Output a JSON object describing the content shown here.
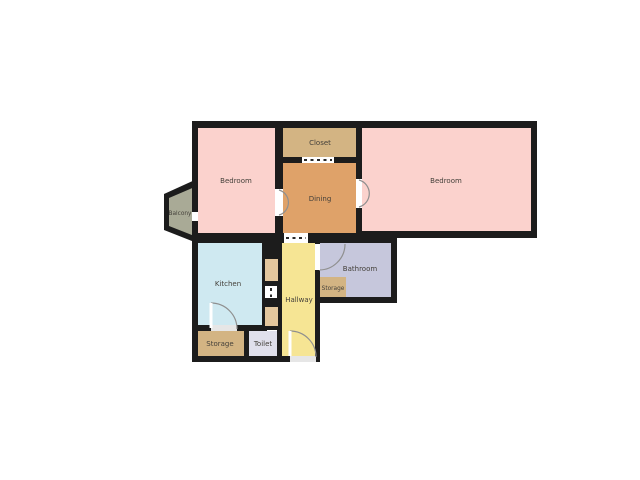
{
  "floorplan": {
    "background_color": "#ffffff",
    "wall_color": "#1c1c1c",
    "label_color": "#44403a",
    "door_arc_color": "#8f8f8f",
    "rooms": {
      "bedroom_left": {
        "label": "Bedroom",
        "color": "#fbd2cd"
      },
      "closet": {
        "label": "Closet",
        "color": "#d3b483"
      },
      "dining": {
        "label": "Dining",
        "color": "#dfa269"
      },
      "bedroom_right": {
        "label": "Bedroom",
        "color": "#fbd2cd"
      },
      "balcony": {
        "label": "Balcony",
        "color": "#a9aa96"
      },
      "kitchen": {
        "label": "Kitchen",
        "color": "#cfe9f1"
      },
      "hallway": {
        "label": "Hallway",
        "color": "#f6e594"
      },
      "bathroom": {
        "label": "Bathroom",
        "color": "#c6c7dc"
      },
      "bathroom_storage": {
        "label": "Storage",
        "color": "#d3b483"
      },
      "storage": {
        "label": "Storage",
        "color": "#d3b483"
      },
      "toilet": {
        "label": "Toilet",
        "color": "#e0e0ec"
      },
      "niche": {
        "color": "#e4c79e"
      }
    }
  }
}
